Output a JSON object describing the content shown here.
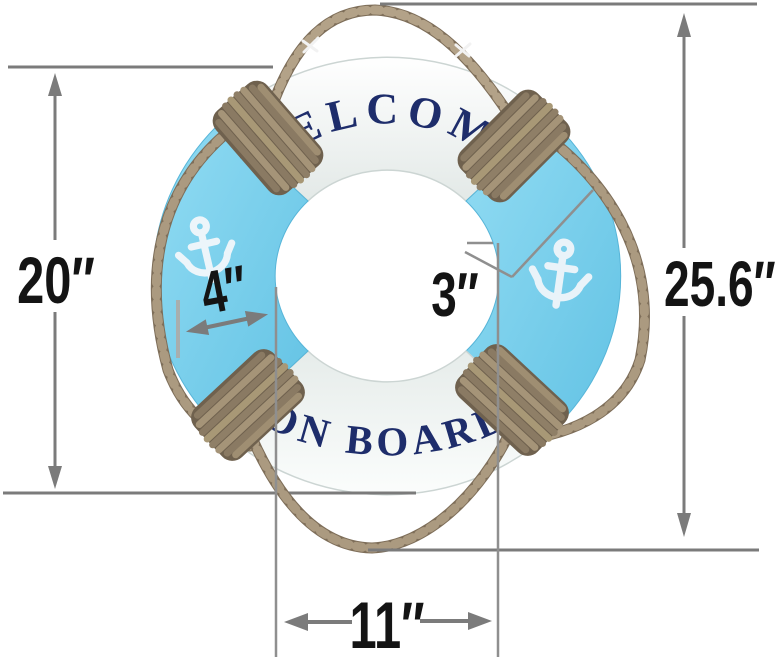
{
  "product": {
    "name": "Welcome On Board decorative life ring with hanging rope",
    "ring_text_top": "WELCOME",
    "ring_text_bottom": "ON BOARD"
  },
  "dimensions": {
    "ring_outer_height": "20″",
    "overall_height_with_rope": "25.6″",
    "tube_width": "4″",
    "tube_thickness": "3″",
    "inner_diameter": "11″"
  },
  "icons": {
    "left_segment": "anchor-icon",
    "right_segment": "anchor-icon"
  },
  "colors": {
    "background": "#ffffff",
    "ring_white": "#f2f5f3",
    "ring_blue": "#7ecfec",
    "rope_tan": "#97866f",
    "rope_dark": "#6f614e",
    "lettering_navy": "#1e2d6b",
    "anchor_white": "#ecf5fa",
    "dimension_gray": "#7b7b7b",
    "label_black": "#141414"
  }
}
